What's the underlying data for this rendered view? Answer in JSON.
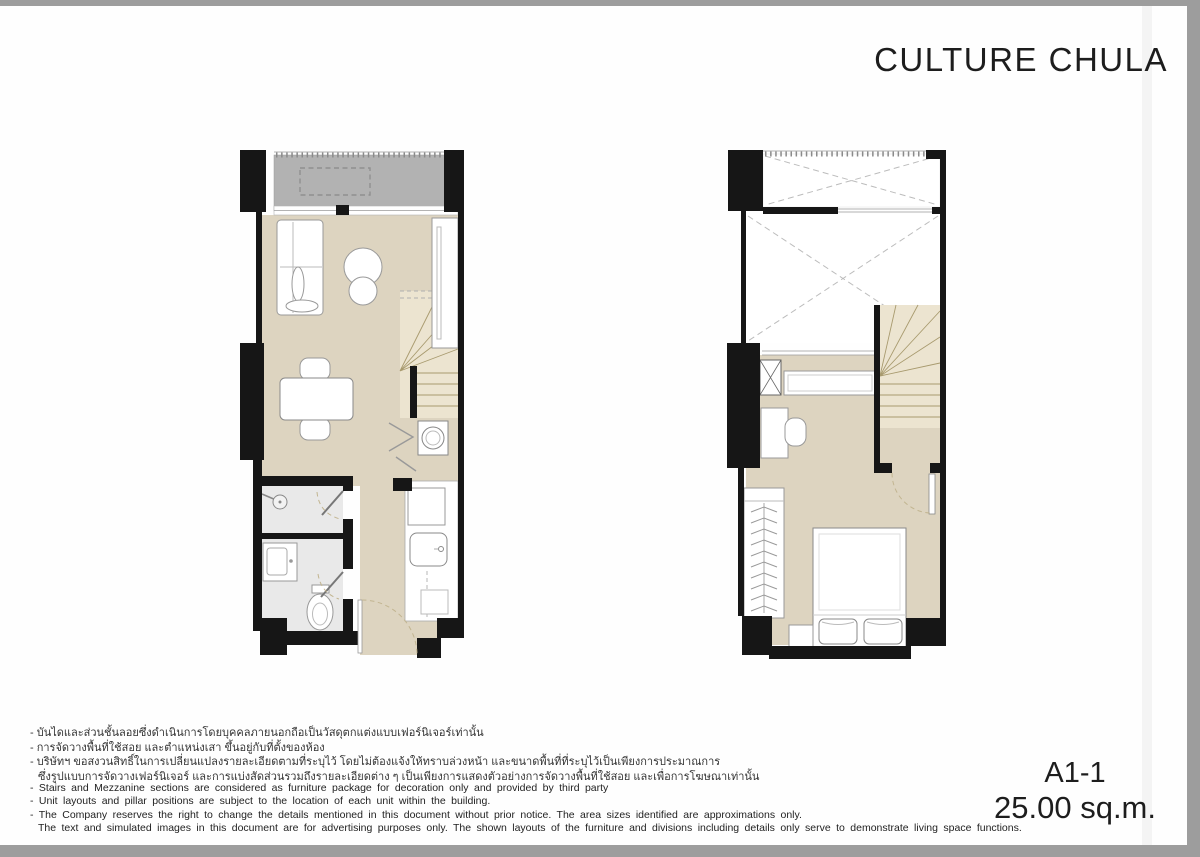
{
  "header": {
    "brand": "CULTURE CHULA"
  },
  "unit": {
    "code": "A1-1",
    "area": "25.00 sq.m."
  },
  "disclaimer_th": [
    "- บันไดและส่วนชั้นลอยซึ่งดำเนินการโดยบุคคลภายนอกถือเป็นวัสดุตกแต่งแบบเฟอร์นิเจอร์เท่านั้น",
    "- การจัดวางพื้นที่ใช้สอย และตำแหน่งเสา ขึ้นอยู่กับที่ตั้งของห้อง",
    "- บริษัทฯ ขอสงวนสิทธิ์ในการเปลี่ยนแปลงรายละเอียดตามที่ระบุไว้ โดยไม่ต้องแจ้งให้ทราบล่วงหน้า และขนาดพื้นที่ที่ระบุไว้เป็นเพียงการประมาณการ",
    "ซึ่งรูปแบบการจัดวางเฟอร์นิเจอร์ และการแบ่งสัดส่วนรวมถึงรายละเอียดต่าง ๆ เป็นเพียงการแสดงตัวอย่างการจัดวางพื้นที่ใช้สอย และเพื่อการโฆษณาเท่านั้น"
  ],
  "disclaimer_en": [
    "- Stairs and Mezzanine sections are considered as furniture package for decoration only and provided by third party",
    "- Unit layouts and pillar positions are subject to the location of each unit within the building.",
    "- The Company reserves the right to change the details mentioned in this document without prior notice. The area sizes identified are approximations only.",
    "The text and simulated images in this document are for advertising purposes only. The shown layouts of the furniture and divisions including details only serve to demonstrate living space functions."
  ],
  "colors": {
    "floor": "#ddd4c0",
    "balcony": "#b2b2b2",
    "bathroom": "#e9e9e9",
    "stair": "#ece4d0",
    "stair_line": "#a89a6e",
    "wall": "#161616",
    "door_arc": "#c2b591",
    "page_bg": "#9d9d9d",
    "paper": "#fefefe"
  }
}
